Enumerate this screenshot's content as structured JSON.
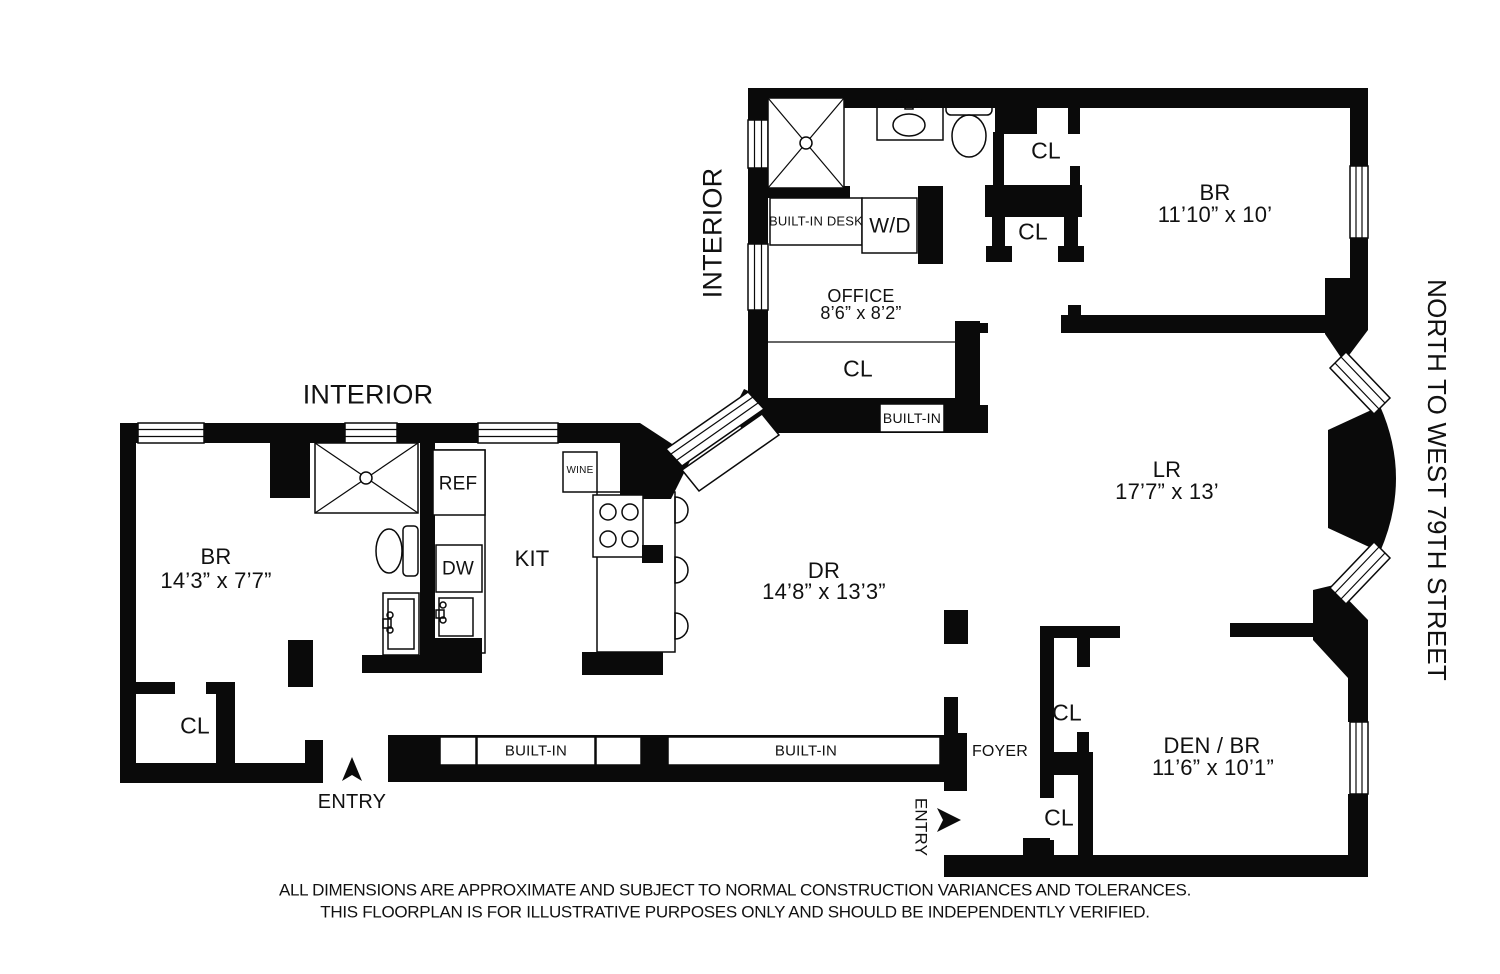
{
  "annotations": {
    "interior_left": "INTERIOR",
    "interior_top": "INTERIOR",
    "street": "NORTH TO WEST 79TH STREET",
    "entry_main": "ENTRY",
    "entry_service": "ENTRY"
  },
  "rooms": {
    "bedroom_top": {
      "name": "BR",
      "dims": "11’10” x 10’"
    },
    "office": {
      "name": "OFFICE",
      "dims": "8’6” x 8’2”"
    },
    "living_room": {
      "name": "LR",
      "dims": "17’7” x 13’"
    },
    "bedroom_left": {
      "name": "BR",
      "dims": "14’3” x 7’7”"
    },
    "dining_room": {
      "name": "DR",
      "dims": "14’8” x 13’3”"
    },
    "den": {
      "name": "DEN / BR",
      "dims": "11’6” x 10’1”"
    },
    "kitchen": {
      "name": "KIT"
    },
    "foyer": {
      "name": "FOYER"
    }
  },
  "closets": {
    "hall_upper": "CL",
    "hall_lower": "CL",
    "office": "CL",
    "bedroom_left": "CL",
    "den": "CL",
    "foyer": "CL"
  },
  "fixtures": {
    "refrigerator": "REF",
    "dishwasher": "DW",
    "wine_cooler": "WINE",
    "washer_dryer": "W/D",
    "built_in_desk": "BUILT-IN DESK",
    "built_in_office": "BUILT-IN",
    "built_in_gallery_left": "BUILT-IN",
    "built_in_gallery_right": "BUILT-IN"
  },
  "disclaimer": {
    "line1": "ALL DIMENSIONS ARE APPROXIMATE AND SUBJECT TO NORMAL CONSTRUCTION VARIANCES AND TOLERANCES.",
    "line2": "THIS FLOORPLAN IS FOR ILLUSTRATIVE PURPOSES ONLY AND SHOULD BE INDEPENDENTLY VERIFIED."
  },
  "colors": {
    "wall": "#0a0a0a",
    "background": "#ffffff"
  }
}
